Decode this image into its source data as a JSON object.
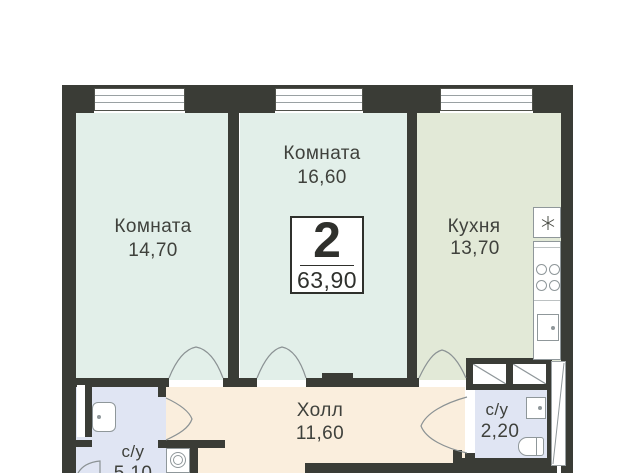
{
  "badge": {
    "rooms_count": "2",
    "total_area": "63,90"
  },
  "rooms": {
    "room1": {
      "label": "Комната",
      "area": "14,70"
    },
    "room2": {
      "label": "Комната",
      "area": "16,60"
    },
    "kitchen": {
      "label": "Кухня",
      "area": "13,70"
    },
    "hall": {
      "label": "Холл",
      "area": "11,60"
    },
    "bathroom_right": {
      "label": "с/у",
      "area": "2,20"
    },
    "bathroom_left": {
      "label": "с/у",
      "area": "5,10"
    }
  },
  "icons": {
    "fridge_star": "✳",
    "stove_burners": "4 circles",
    "kitchen_sink": "square with dot",
    "bathroom_sink": "rounded square with dot",
    "toilet": "stadium shape",
    "washing_machine": "box with double circle",
    "wardrobe": "box with diagonal",
    "entrance_door": "white leaf with diagonal"
  },
  "colors": {
    "wall": "#3a3c36",
    "room-fill": "#e2efe9",
    "kitchen-fill": "#e2e9d7",
    "hall-fill": "#faeedd",
    "bath-fill": "#e0e5f3",
    "fixture-line": "#8f979a",
    "arc-line": "#8b9294",
    "text": "#3f413c",
    "badge": "#2f302c",
    "window-line": "#9aa1a3"
  }
}
